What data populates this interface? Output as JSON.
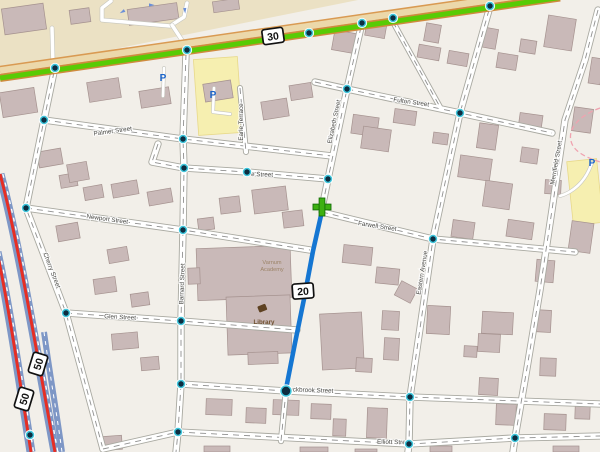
{
  "map": {
    "background": "#f2efe9",
    "palette": {
      "road_fill": "#ffffff",
      "road_casing": "#a9a9a1",
      "road_dash": "#909090",
      "trunk_green": "#58cb05",
      "trunk_casing": "#cf8a3e",
      "band_fill": "#ecd8aa",
      "band_edge": "#d99a52",
      "motorway_casing": "#7e97c6",
      "motorway_core": "#e62e24",
      "route_blue": "#1576d2",
      "plus_green": "#3db012",
      "node_ring": "#3fc6dc",
      "node_core": "#0d2d40",
      "building_fill": "#c9b9b8",
      "building_stroke": "#a5928f",
      "retail_fill": "#ebe1c4",
      "parking_fill": "#f6efb0",
      "boundary_pink": "#f0a3b0",
      "label_color": "#4a4a46",
      "poi_blue": "#1a63c8",
      "poi_brown": "#6e4f2e",
      "school_brown": "#9c8468"
    },
    "landuse": {
      "retail_polygon": "0,0 358,0 0,72",
      "parking_patches": [
        [
          196,
          58,
          44,
          76,
          -4
        ],
        [
          570,
          160,
          30,
          64,
          -6
        ]
      ]
    },
    "minor_paths": [
      {
        "d": "M 111,1 L 102,8 L 102,20 L 170,26 L 184,17 L 187,3",
        "w": 3.5
      },
      {
        "d": "M 172,25 L 187,48",
        "w": 3.5
      },
      {
        "d": "M 53,63 L 52,28",
        "w": 3.5
      },
      {
        "d": "M 164,68 L 163,96",
        "w": 2.6
      },
      {
        "d": "M 214,88 L 213,112 L 230,114",
        "w": 2.6
      },
      {
        "d": "M 560,196 C 574,192 584,181 589,170 L 592,163",
        "w": 2.6
      }
    ],
    "streets": [
      {
        "name": "Barnard Street",
        "d": "M 186,54 L 183,139 L 184,168 L 183,230 L 181,321 L 181,384 L 178,432 L 176,452",
        "w": 5.5
      },
      {
        "name": "Cherry Street",
        "d": "M 54,72 L 44,120 L 26,208 L 66,313 L 103,449",
        "w": 5.5
      },
      {
        "name": "Palmer Street",
        "d": "M 44,120 L 183,139 L 332,156",
        "w": 5.5
      },
      {
        "name": "e Street",
        "d": "M 158,144 L 152,162 L 184,168 L 247,172 L 328,179",
        "w": 5.5
      },
      {
        "name": "Newport Street",
        "d": "M 26,208 L 183,230 L 310,250",
        "w": 5.5
      },
      {
        "name": "Glen Street",
        "d": "M 66,313 L 181,321 L 297,330",
        "w": 5.5
      },
      {
        "name": "Rockbrook Street",
        "d": "M 181,384 L 286,391 L 410,397 L 600,404",
        "w": 5.5
      },
      {
        "name": "Elliott Street",
        "d": "M 103,449 L 178,432 L 409,444 L 515,438 L 600,436",
        "w": 5.5
      },
      {
        "name": "Elizabeth Street",
        "d": "M 361,27 L 347,89 L 328,179 L 322,208",
        "w": 5.5
      },
      {
        "name": "Elizabeth Street lower",
        "d": "M 286,391 L 281,441",
        "w": 4.5
      },
      {
        "name": "Eastern Avenue",
        "d": "M 489,10 L 460,113 L 433,239 L 410,397 L 409,444 L 408,452",
        "w": 5.5
      },
      {
        "name": "Fulton Street",
        "d": "M 315,82 L 347,89 L 460,113 L 552,133",
        "w": 5.5
      },
      {
        "name": "Farwell Street",
        "d": "M 322,212 L 433,239 L 575,252",
        "w": 5.5
      },
      {
        "name": "Merrifield Street",
        "d": "M 598,10 L 585,60 L 565,120 L 552,210 L 540,290 L 525,380 L 515,438 L 513,452",
        "w": 5.5
      },
      {
        "name": "Earle Terrace",
        "d": "M 240,88 L 246,152",
        "w": 4.2
      },
      {
        "name": "connector",
        "d": "M 393,22 L 440,107",
        "w": 4.2
      }
    ],
    "trunk": {
      "road_d": "M 0,78 L 560,-2.5",
      "band_d": "M 0,70.5 L 560,-10"
    },
    "motorway": {
      "carriageways": [
        {
          "d": "M -3,252 C 8,302 20,382 31,452",
          "dash_d": "M -0.5,252 C 10.5,302 22.5,382 33.5,452"
        },
        {
          "d": "M 0,174 C 18,240 38,360 55,452",
          "dash_d": "M 2.8,174 C 20.8,240 40.8,360 57.8,452"
        }
      ],
      "ramp": {
        "d": "M 44,332 C 50,375 57,415 62,452"
      }
    },
    "boundary_d": "M 600,108 C 578,116 566,130 572,144 C 576,153 588,158 600,162",
    "buildings": [
      [
        3,
        6,
        42,
        26,
        -8
      ],
      [
        70,
        9,
        20,
        14,
        -8
      ],
      [
        128,
        6,
        50,
        16,
        -8
      ],
      [
        213,
        0,
        26,
        11,
        -8
      ],
      [
        1,
        90,
        35,
        25,
        -9
      ],
      [
        88,
        80,
        32,
        20,
        -9
      ],
      [
        140,
        89,
        30,
        17,
        -9
      ],
      [
        38,
        150,
        24,
        16,
        -10
      ],
      [
        60,
        174,
        17,
        13,
        -10
      ],
      [
        84,
        186,
        19,
        13,
        -10
      ],
      [
        108,
        248,
        20,
        14,
        -10
      ],
      [
        112,
        182,
        26,
        14,
        -10
      ],
      [
        148,
        190,
        24,
        14,
        -10
      ],
      [
        68,
        163,
        20,
        18,
        -10
      ],
      [
        57,
        224,
        22,
        16,
        -10
      ],
      [
        94,
        278,
        22,
        15,
        -8
      ],
      [
        131,
        293,
        18,
        13,
        -8
      ],
      [
        112,
        333,
        26,
        16,
        -5
      ],
      [
        141,
        357,
        18,
        13,
        -5
      ],
      [
        204,
        82,
        28,
        18,
        -9
      ],
      [
        262,
        100,
        26,
        18,
        -9
      ],
      [
        290,
        84,
        22,
        15,
        -9
      ],
      [
        253,
        188,
        34,
        24,
        -7
      ],
      [
        220,
        197,
        20,
        16,
        -7
      ],
      [
        283,
        211,
        20,
        16,
        -7
      ],
      [
        198,
        218,
        16,
        12,
        -7
      ],
      [
        197,
        247,
        94,
        52,
        -2
      ],
      [
        227,
        296,
        64,
        58,
        -2
      ],
      [
        188,
        268,
        12,
        16,
        -2
      ],
      [
        248,
        352,
        30,
        12,
        -2
      ],
      [
        333,
        32,
        26,
        20,
        10
      ],
      [
        366,
        20,
        20,
        17,
        10
      ],
      [
        425,
        24,
        15,
        18,
        10
      ],
      [
        480,
        28,
        17,
        20,
        10
      ],
      [
        418,
        46,
        22,
        13,
        10
      ],
      [
        448,
        52,
        20,
        13,
        10
      ],
      [
        520,
        40,
        16,
        13,
        9
      ],
      [
        546,
        17,
        28,
        32,
        9
      ],
      [
        497,
        54,
        20,
        15,
        9
      ],
      [
        590,
        58,
        12,
        26,
        9
      ],
      [
        352,
        116,
        26,
        19,
        8
      ],
      [
        394,
        110,
        22,
        14,
        8
      ],
      [
        362,
        128,
        28,
        22,
        8
      ],
      [
        478,
        124,
        19,
        25,
        8
      ],
      [
        519,
        114,
        23,
        16,
        8
      ],
      [
        573,
        108,
        19,
        24,
        8
      ],
      [
        433,
        133,
        15,
        11,
        8
      ],
      [
        459,
        157,
        32,
        22,
        8
      ],
      [
        484,
        182,
        27,
        26,
        8
      ],
      [
        521,
        148,
        17,
        15,
        8
      ],
      [
        545,
        180,
        16,
        14,
        3
      ],
      [
        452,
        221,
        22,
        17,
        8
      ],
      [
        507,
        221,
        26,
        17,
        8
      ],
      [
        570,
        222,
        22,
        30,
        8
      ],
      [
        536,
        260,
        18,
        22,
        5
      ],
      [
        533,
        310,
        18,
        22,
        3
      ],
      [
        540,
        358,
        16,
        18,
        2
      ],
      [
        343,
        246,
        29,
        18,
        6
      ],
      [
        376,
        268,
        23,
        16,
        6
      ],
      [
        397,
        284,
        18,
        16,
        28
      ],
      [
        321,
        313,
        42,
        56,
        -3
      ],
      [
        382,
        311,
        17,
        19,
        3
      ],
      [
        384,
        338,
        15,
        22,
        3
      ],
      [
        356,
        358,
        16,
        14,
        3
      ],
      [
        427,
        306,
        23,
        28,
        3
      ],
      [
        482,
        312,
        31,
        22,
        3
      ],
      [
        478,
        334,
        22,
        18,
        3
      ],
      [
        464,
        346,
        13,
        11,
        3
      ],
      [
        479,
        378,
        19,
        17,
        3
      ],
      [
        206,
        399,
        26,
        16,
        2
      ],
      [
        246,
        408,
        20,
        15,
        2
      ],
      [
        273,
        400,
        26,
        15,
        2
      ],
      [
        311,
        404,
        20,
        15,
        2
      ],
      [
        367,
        408,
        20,
        30,
        2
      ],
      [
        333,
        419,
        13,
        17,
        2
      ],
      [
        496,
        404,
        20,
        21,
        2
      ],
      [
        544,
        414,
        22,
        16,
        2
      ],
      [
        575,
        406,
        15,
        13,
        2
      ],
      [
        100,
        436,
        22,
        14,
        -4
      ],
      [
        204,
        446,
        26,
        6,
        0
      ],
      [
        300,
        447,
        28,
        5,
        0
      ],
      [
        430,
        446,
        22,
        6,
        0
      ],
      [
        553,
        446,
        26,
        6,
        0
      ],
      [
        355,
        449,
        22,
        3,
        0
      ]
    ],
    "route": {
      "d": "M 322,211 L 313,251 L 304,299 L 295,343 L 286,389",
      "start": [
        322,
        207
      ],
      "end": [
        286,
        391
      ]
    },
    "nodes": [
      [
        55,
        68
      ],
      [
        187,
        50
      ],
      [
        309,
        33
      ],
      [
        362,
        23
      ],
      [
        393,
        18
      ],
      [
        490,
        6
      ],
      [
        44,
        120
      ],
      [
        183,
        139
      ],
      [
        184,
        168
      ],
      [
        247,
        172
      ],
      [
        328,
        179
      ],
      [
        347,
        89
      ],
      [
        460,
        113
      ],
      [
        26,
        208
      ],
      [
        183,
        230
      ],
      [
        433,
        239
      ],
      [
        66,
        313
      ],
      [
        181,
        321
      ],
      [
        181,
        384
      ],
      [
        178,
        432
      ],
      [
        30,
        435
      ],
      [
        410,
        397
      ],
      [
        409,
        444
      ],
      [
        515,
        438
      ]
    ],
    "shields": [
      {
        "label": "30",
        "x": 273,
        "y": 36,
        "rot": -8
      },
      {
        "label": "20",
        "x": 303,
        "y": 291,
        "rot": -4
      },
      {
        "label": "50",
        "x": 38,
        "y": 364,
        "rot": -73
      },
      {
        "label": "50",
        "x": 24,
        "y": 399,
        "rot": -73
      }
    ],
    "street_labels": [
      {
        "text": "Palmer Street",
        "x": 113,
        "y": 133,
        "rot": -8
      },
      {
        "text": "e Street",
        "x": 251,
        "y": 176,
        "rot": 2,
        "anchor": "start"
      },
      {
        "text": "Fulton Street",
        "x": 411,
        "y": 104,
        "rot": 8
      },
      {
        "text": "Earle Terrace",
        "x": 243,
        "y": 122,
        "rot": -90
      },
      {
        "text": "Elizabeth Street",
        "x": 336,
        "y": 122,
        "rot": -78
      },
      {
        "text": "Newport Street",
        "x": 107,
        "y": 221,
        "rot": 8
      },
      {
        "text": "Farwell Street",
        "x": 377,
        "y": 228,
        "rot": 9
      },
      {
        "text": "Eastern Avenue",
        "x": 424,
        "y": 273,
        "rot": -81
      },
      {
        "text": "Merrifield Street",
        "x": 558,
        "y": 163,
        "rot": -80
      },
      {
        "text": "Glen Street",
        "x": 120,
        "y": 319,
        "rot": 3
      },
      {
        "text": "Cherry Street",
        "x": 50,
        "y": 271,
        "rot": 69
      },
      {
        "text": "Barnard Street",
        "x": 184,
        "y": 284,
        "rot": -88
      },
      {
        "text": "Rockbrook Street",
        "x": 309,
        "y": 392,
        "rot": 2
      },
      {
        "text": "Elliott Street",
        "x": 394,
        "y": 444,
        "rot": 1
      }
    ],
    "pois": {
      "parking_label": "P",
      "parking_positions": [
        [
          163,
          81
        ],
        [
          213,
          98
        ],
        [
          592,
          166
        ]
      ],
      "school": {
        "lines": [
          "Varnum",
          "Academy"
        ],
        "x": 272,
        "y": 264
      },
      "library": {
        "label": "Library",
        "icon_x": 262,
        "icon_y": 308,
        "label_x": 264,
        "label_y": 324
      }
    },
    "oneway_arrows": [
      [
        122,
        12,
        150
      ],
      [
        152,
        5,
        0
      ],
      [
        185,
        11,
        85
      ]
    ]
  }
}
